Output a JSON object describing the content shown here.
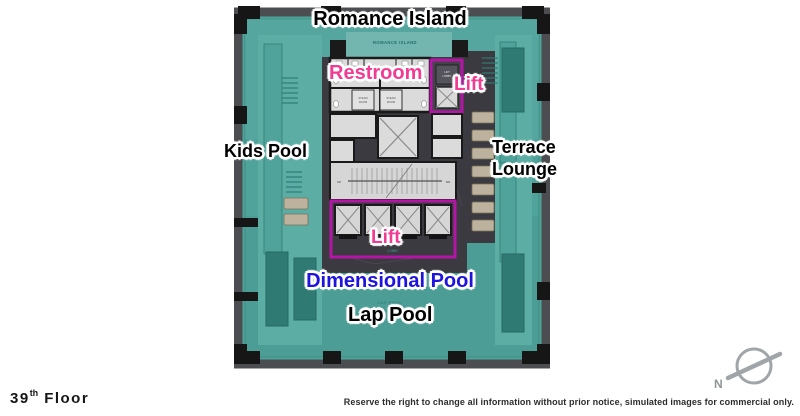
{
  "overlay_labels": {
    "romance_island": "Romance Island",
    "restroom": "Restroom",
    "lift_top": "Lift",
    "kids_pool": "Kids Pool",
    "terrace_line1": "Terrace",
    "terrace_line2": "Lounge",
    "lift_bottom": "Lift",
    "dimensional_pool": "Dimensional Pool",
    "lap_pool": "Lap Pool"
  },
  "plan_texts": {
    "romance_island_small": "ROMANCE ISLAND",
    "terrace_small": "TERRACE",
    "lap_pool_small": "LAP POOL",
    "lobby": "LOBBY",
    "up": "UP",
    "dn": "DN",
    "steam_line1": "STEAM",
    "steam_line2": "ROOM",
    "lift_lobby_line1": "LIFT",
    "lift_lobby_line2": "LOBBY"
  },
  "footer": {
    "floor_number": "39",
    "floor_ordinal": "th",
    "floor_word": "Floor",
    "disclaimer": "Reserve the right to change all information without prior notice, simulated images for commercial only."
  },
  "compass": {
    "north_label": "N"
  },
  "colors": {
    "pool_water": "#50A39B",
    "deck": "#5CAEA5",
    "planter": "#2F7B73",
    "frame": "#4C4D51",
    "column_black": "#161616",
    "core_marble": "#3B3A40",
    "room_fill": "#DBDBDB",
    "wall": "#1A1A1A",
    "lift_highlight": "#B415A6",
    "label_pink": "#F23C93",
    "label_blue": "#1E14DE",
    "chair": "#BDB29D"
  }
}
